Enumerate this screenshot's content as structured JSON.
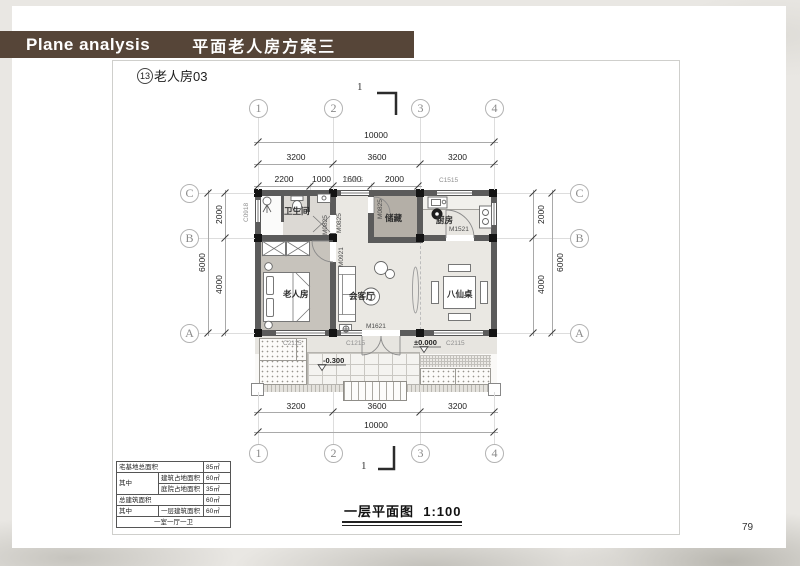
{
  "header": {
    "en": "Plane analysis",
    "zh": "平面老人房方案三"
  },
  "subtitle": {
    "num": "13",
    "text": "老人房03"
  },
  "section_mark": {
    "top": "1",
    "bottom": "1"
  },
  "grid": {
    "cols": [
      "1",
      "2",
      "3",
      "4"
    ],
    "rows": [
      "C",
      "B",
      "A"
    ]
  },
  "dims": {
    "top_total": "10000",
    "top_major": [
      "3200",
      "3600",
      "3200"
    ],
    "top_minor": [
      "2200",
      "1000",
      "1600",
      "2000"
    ],
    "bottom_major": [
      "3200",
      "3600",
      "3200"
    ],
    "bottom_total": "10000",
    "side_upper": "2000",
    "side_lower": "4000",
    "side_total": "6000"
  },
  "rooms": {
    "bathroom": "卫生间",
    "storage": "储藏",
    "kitchen": "厨房",
    "bedroom": "老人房",
    "living": "会客厅",
    "dining_table": "八仙桌"
  },
  "openings": {
    "c0918": "C0918",
    "c1215": "C1215",
    "c1515": "C1515",
    "c2115": "C2115",
    "m0825": "M0825",
    "m0921": "M0921",
    "m1521": "M1521",
    "m1621": "M1621"
  },
  "levels": {
    "zero": "±0.000",
    "minus": "-0.300"
  },
  "area_table": {
    "r1_label": "宅基地总面积",
    "r1_value": "85㎡",
    "r2_label": "其中",
    "r2_sub": "建筑占地面积",
    "r2_value": "60㎡",
    "r3_sub": "庭院占地面积",
    "r3_value": "35㎡",
    "r4_label": "总建筑面积",
    "r4_value": "60㎡",
    "r5_label": "其中",
    "r5_sub": "一层建筑面积",
    "r5_value": "60㎡",
    "r6_footer": "一室一厅一卫"
  },
  "caption": {
    "title": "一层平面图",
    "scale": "1:100"
  },
  "page_number": "79"
}
